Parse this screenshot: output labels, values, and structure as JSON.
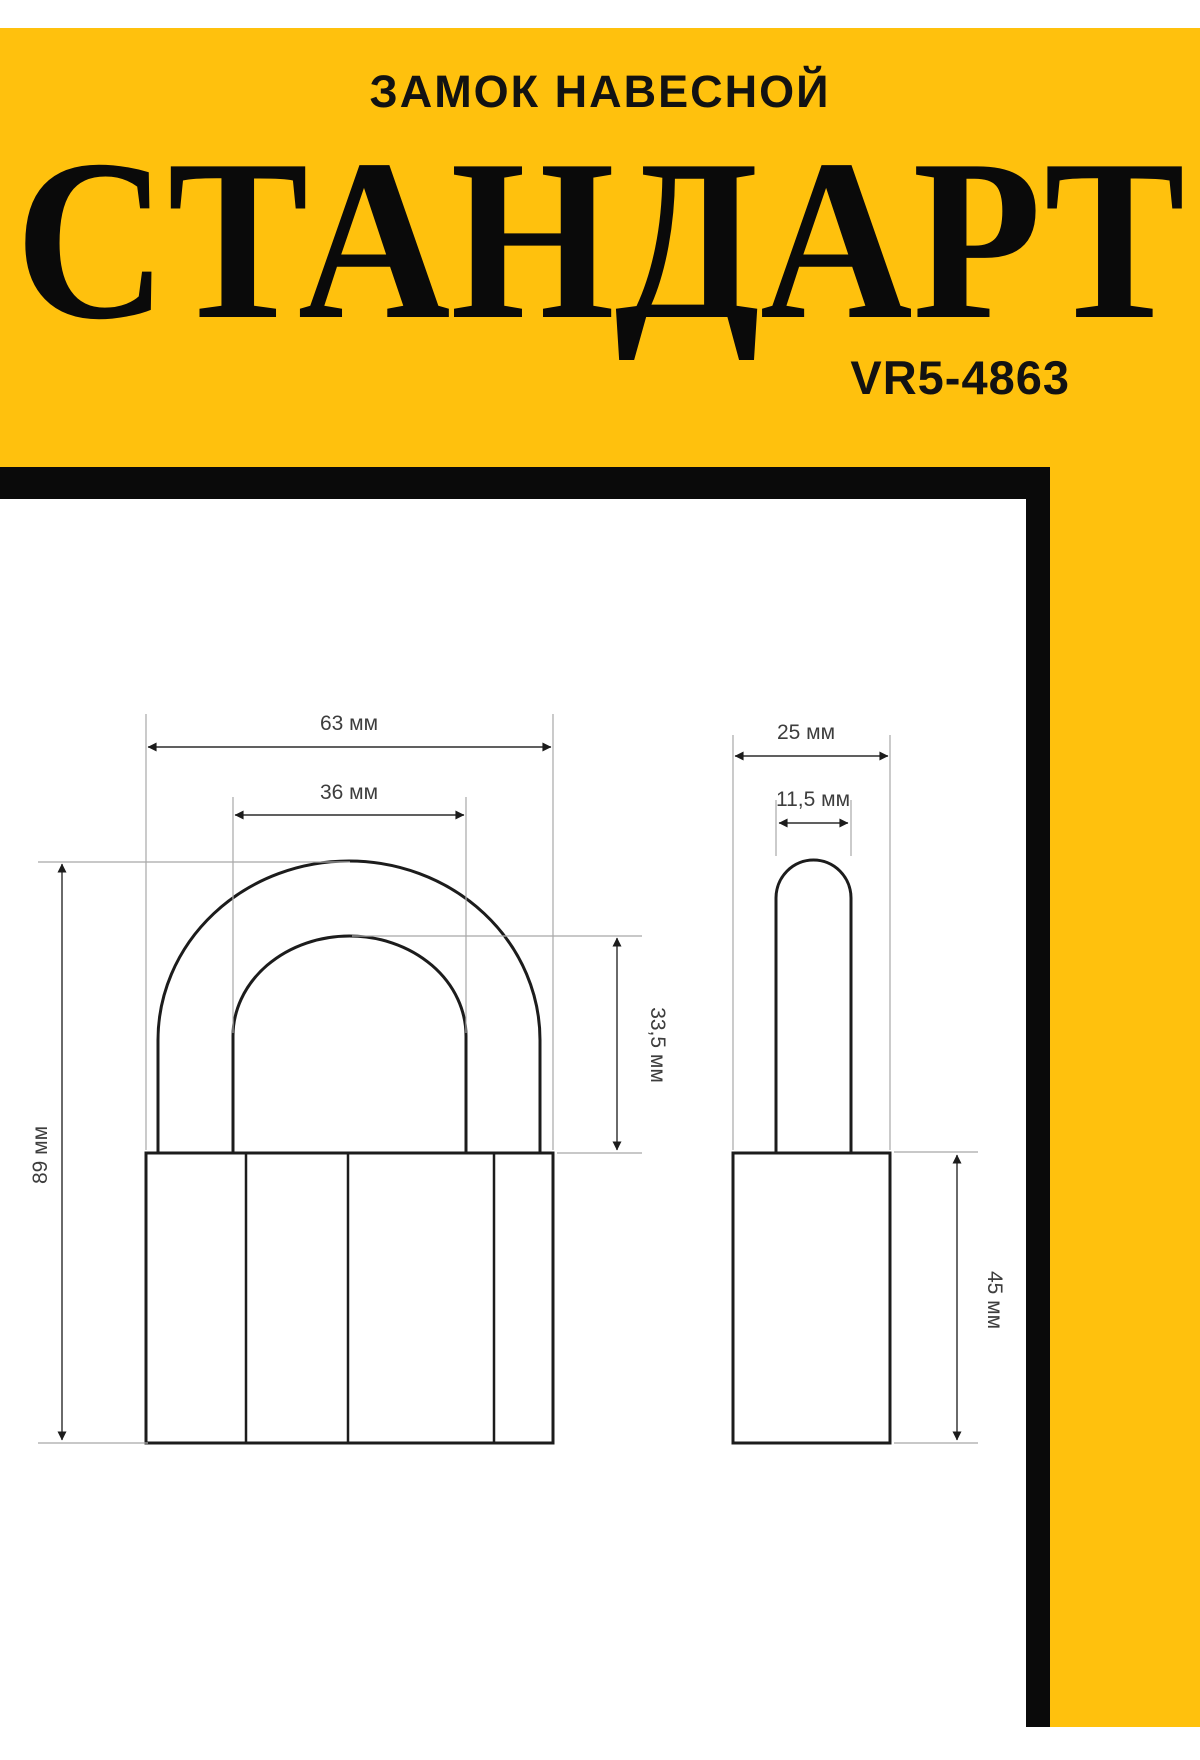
{
  "header": {
    "category": "ЗАМОК НАВЕСНОЙ",
    "product_name": "СТАНДАРТ",
    "model_number": "VR5-4863"
  },
  "colors": {
    "accent_yellow": "#FFC10D",
    "frame_black": "#0A0A0A",
    "drawing_line": "#1C1C1C",
    "extension_line": "#A8A8A8",
    "dimension_text": "#3D3D3D"
  },
  "drawing": {
    "views": {
      "front": "padlock-front-view",
      "side": "padlock-side-view"
    },
    "dimensions": {
      "front_overall_width": "63 мм",
      "front_inner_width": "36 мм",
      "front_overall_height": "89 мм",
      "front_opening_height": "33,5 мм",
      "side_body_depth": "25 мм",
      "side_shackle_thickness": "11,5 мм",
      "side_body_height": "45 мм"
    }
  }
}
